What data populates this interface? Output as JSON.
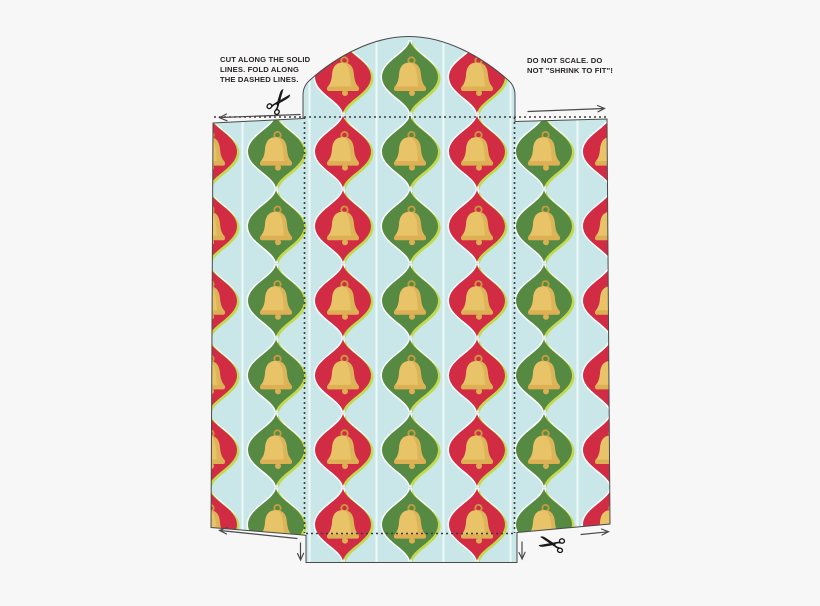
{
  "page": {
    "background": "#f7f7f7",
    "description": "Printable holiday gift-bag / envelope die-cut template with bell ornament pattern"
  },
  "notes": {
    "cut": {
      "line1": "CUT ALONG THE SOLID",
      "line2": "LINES. FOLD ALONG",
      "line3": "THE DASHED LINES."
    },
    "scale": {
      "line1": "DO NOT SCALE. DO",
      "line2": "NOT \"SHRINK TO FIT\"!"
    }
  },
  "colors": {
    "paper_blue": "#c9e7e8",
    "pinstripe": "#eef8f8",
    "diamond_red": "#d22c45",
    "diamond_green": "#568a42",
    "diamond_highlight": "#c3da4f",
    "diamond_halo": "#ffffff",
    "bell_gold": "#e9c367",
    "bell_lip": "#ddb054",
    "bell_shade": "#c99a3f",
    "bell_outline": "#c89b3e",
    "cut_line": "#4a4a4a",
    "fold_line": "#3c3c3c",
    "arrow": "#4a4a4a",
    "text": "#2a2424"
  },
  "pattern": {
    "motif": "christmas-bell-ornament",
    "columns": [
      {
        "x": 209,
        "color": "red"
      },
      {
        "x": 276,
        "color": "green"
      },
      {
        "x": 343,
        "color": "red"
      },
      {
        "x": 410,
        "color": "green"
      },
      {
        "x": 477,
        "color": "red"
      },
      {
        "x": 544,
        "color": "green"
      },
      {
        "x": 611,
        "color": "red"
      }
    ],
    "row_start": 77,
    "row_spacing": 74.6,
    "row_count": 7,
    "diamond": {
      "width": 56,
      "height": 73
    },
    "stripes_x": [
      242.5,
      309.5,
      376.5,
      443.5,
      510.5,
      577.5
    ]
  },
  "icons": {
    "scissors_top": "scissors-icon",
    "scissors_bottom": "scissors-icon",
    "bell": "bell-icon"
  }
}
